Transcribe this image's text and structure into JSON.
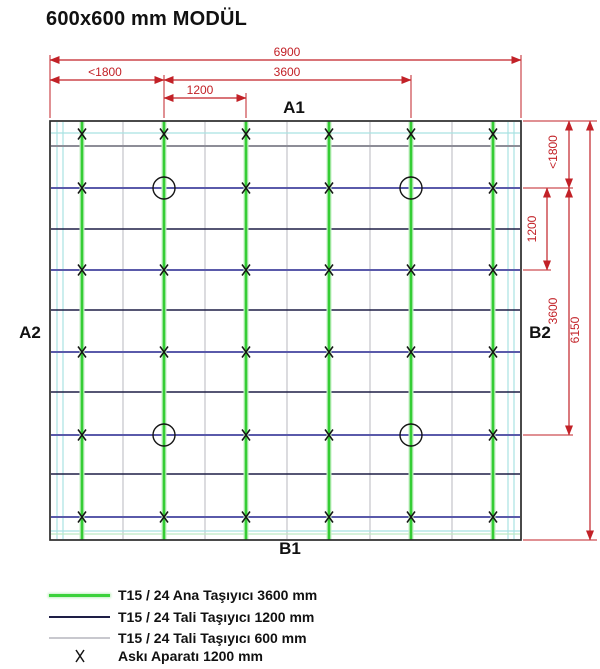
{
  "title": "600x600 mm MODÜL",
  "side_labels": {
    "top": "A1",
    "left": "A2",
    "bottom": "B1",
    "right": "B2"
  },
  "legend": {
    "items": [
      {
        "swatch": "main-runner-line",
        "label": "T15 / 24 Ana Taşıyıcı 3600 mm"
      },
      {
        "swatch": "cross-tee-1200-line",
        "label": "T15 / 24 Tali Taşıyıcı 1200 mm"
      },
      {
        "swatch": "cross-tee-600-line",
        "label": "T15 / 24 Tali Taşıyıcı 600 mm"
      },
      {
        "swatch": "hanger-x-mark",
        "label": "Askı Aparatı 1200 mm"
      }
    ]
  },
  "colors": {
    "dimension": "#c22127",
    "main_runner": "#35cd35",
    "main_runner_halo": "#c6efc6",
    "cross_tee_1200_blue": "#5a5aaa",
    "cross_tee_1200_dark": "#1e1e46",
    "cross_tee_600": "#c8c8ce",
    "edge_line": "#a9e2e2",
    "edge_line_green": "#bfe9c4",
    "gray_line": "#8d8d97",
    "border": "#2b2b2b",
    "marker": "#151515"
  },
  "chart_data": {
    "type": "diagram",
    "subtype": "suspended-ceiling-plan",
    "module": "600x600 mm",
    "units": "mm",
    "plan_width_mm": 6900,
    "plan_height_mm": 6150,
    "main_runner_length_mm": 3600,
    "main_runner_spacing_mm": 1200,
    "cross_tee_long_mm": 1200,
    "cross_tee_short_mm": 600,
    "hanger_spacing_mm": 1200,
    "edge_distance_max_mm": 1800,
    "dimensions_top": [
      "6900",
      "<1800",
      "3600",
      "1200"
    ],
    "dimensions_right": [
      "<1800",
      "1200",
      "3600",
      "6150"
    ]
  },
  "drawing": {
    "border": {
      "x": 50,
      "y": 121,
      "w": 471,
      "h": 419
    },
    "main_runners_x": [
      82,
      164,
      246,
      329,
      411,
      493
    ],
    "cross600_x": [
      123,
      205,
      287,
      370,
      452
    ],
    "edge_vertical_x": [
      57,
      63,
      508,
      514
    ],
    "rows": [
      {
        "y": 133,
        "style": "edge"
      },
      {
        "y": 146,
        "style": "gray"
      },
      {
        "y": 188,
        "style": "blue"
      },
      {
        "y": 229,
        "style": "dark"
      },
      {
        "y": 270,
        "style": "blue"
      },
      {
        "y": 310,
        "style": "dark"
      },
      {
        "y": 352,
        "style": "blue"
      },
      {
        "y": 392,
        "style": "dark"
      },
      {
        "y": 435,
        "style": "blue"
      },
      {
        "y": 474,
        "style": "dark"
      },
      {
        "y": 517,
        "style": "blue"
      },
      {
        "y": 531,
        "style": "edge"
      },
      {
        "y": 534,
        "style": "edgegreen"
      }
    ],
    "hanger_rows_y": [
      134,
      188,
      270,
      352,
      435,
      517
    ],
    "circles": [
      {
        "x": 164,
        "y": 188
      },
      {
        "x": 411,
        "y": 188
      },
      {
        "x": 164,
        "y": 435
      },
      {
        "x": 411,
        "y": 435
      }
    ],
    "circle_r": 11
  },
  "dims": {
    "top": [
      {
        "label": "6900",
        "y": 60,
        "x1": 50,
        "x2": 521,
        "tx": 287
      },
      {
        "label": "<1800",
        "y": 80,
        "x1": 50,
        "x2": 164,
        "tx": 105
      },
      {
        "label": "3600",
        "y": 80,
        "x1": 164,
        "x2": 411,
        "tx": 287
      },
      {
        "label": "1200",
        "y": 98,
        "x1": 164,
        "x2": 246,
        "tx": 200
      }
    ],
    "top_ext": [
      {
        "x": 50,
        "y1": 55,
        "y2": 118
      },
      {
        "x": 521,
        "y1": 55,
        "y2": 118
      },
      {
        "x": 164,
        "y1": 75,
        "y2": 118
      },
      {
        "x": 411,
        "y1": 75,
        "y2": 118
      },
      {
        "x": 246,
        "y1": 93,
        "y2": 118
      }
    ],
    "right": [
      {
        "label": "<1800",
        "x": 569,
        "y1": 121,
        "y2": 188,
        "tx": 557,
        "ty": 152
      },
      {
        "label": "1200",
        "x": 547,
        "y1": 188,
        "y2": 270,
        "tx": 536,
        "ty": 229
      },
      {
        "label": "3600",
        "x": 569,
        "y1": 188,
        "y2": 435,
        "tx": 557,
        "ty": 311
      },
      {
        "label": "6150",
        "x": 590,
        "y1": 121,
        "y2": 540,
        "tx": 579,
        "ty": 330
      }
    ],
    "right_ext": [
      {
        "y": 121,
        "x1": 523,
        "x2": 597
      },
      {
        "y": 188,
        "x1": 523,
        "x2": 573
      },
      {
        "y": 270,
        "x1": 523,
        "x2": 551
      },
      {
        "y": 435,
        "x1": 523,
        "x2": 573
      },
      {
        "y": 540,
        "x1": 523,
        "x2": 597
      }
    ]
  },
  "label_positions": {
    "a1": {
      "x": 294,
      "y": 98
    },
    "a2": {
      "x": 30,
      "y": 323
    },
    "b1": {
      "x": 290,
      "y": 539
    },
    "b2": {
      "x": 540,
      "y": 323
    }
  },
  "legend_rows_top": [
    587,
    609,
    630,
    648
  ]
}
